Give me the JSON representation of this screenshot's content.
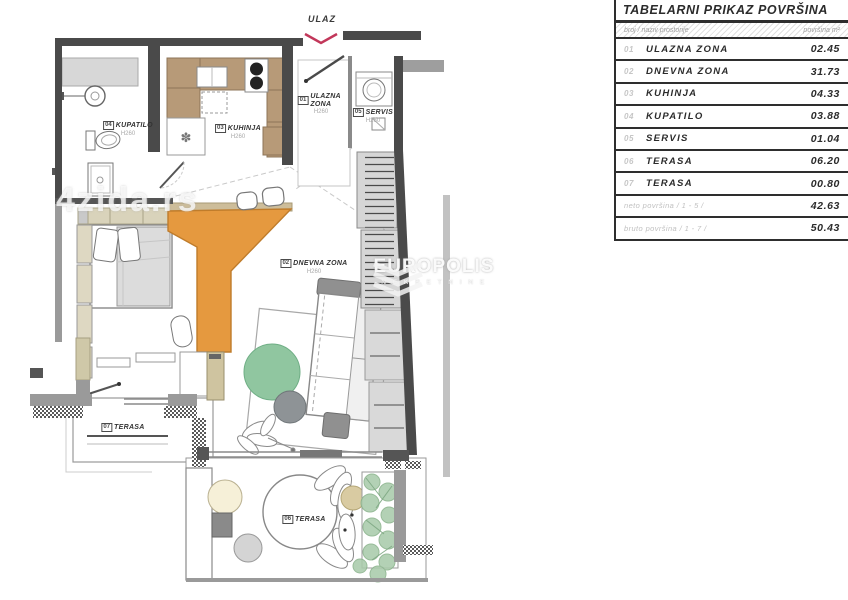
{
  "floorplan": {
    "entrance_label": "ULAZ",
    "rooms": {
      "ulazna": {
        "num": "01",
        "name": "ULAZNA ZONA",
        "height": "H260"
      },
      "dnevna": {
        "num": "02",
        "name": "DNEVNA ZONA",
        "height": "H260"
      },
      "kuhinja": {
        "num": "03",
        "name": "KUHINJA",
        "height": "H260"
      },
      "kupatilo": {
        "num": "04",
        "name": "KUPATILO",
        "height": "H260"
      },
      "servis": {
        "num": "05",
        "name": "SERVIS",
        "height": "H260"
      },
      "terasa6": {
        "num": "06",
        "name": "TERASA"
      },
      "terasa7": {
        "num": "07",
        "name": "TERASA"
      }
    },
    "watermarks": {
      "portal": "4zida.rs",
      "agency": "EUROPOLIS",
      "agency_sub": "N E K R E T N I N E"
    }
  },
  "table": {
    "title": "TABELARNI PRIKAZ POVRŠINA",
    "col_left": "broj / naziv prostorije",
    "col_right": "površina m²",
    "rows": [
      {
        "num": "01",
        "name": "ULAZNA ZONA",
        "value": "02.45"
      },
      {
        "num": "02",
        "name": "DNEVNA ZONA",
        "value": "31.73"
      },
      {
        "num": "03",
        "name": "KUHINJA",
        "value": "04.33"
      },
      {
        "num": "04",
        "name": "KUPATILO",
        "value": "03.88"
      },
      {
        "num": "05",
        "name": "SERVIS",
        "value": "01.04"
      },
      {
        "num": "06",
        "name": "TERASA",
        "value": "06.20"
      },
      {
        "num": "07",
        "name": "TERASA",
        "value": "00.80"
      }
    ],
    "summary": [
      {
        "label": "neto površina / 1 - 5 /",
        "value": "42.63"
      },
      {
        "label": "bruto površina / 1 - 7 /",
        "value": "50.43"
      }
    ]
  },
  "colors": {
    "accent_red": "#c2375a",
    "desk_orange": "#e5993f",
    "kitchen_tan": "#b79a78",
    "rug_green": "#90c6a0",
    "plant_green": "#a9cbab",
    "wall_dark": "#4a4a4a"
  }
}
